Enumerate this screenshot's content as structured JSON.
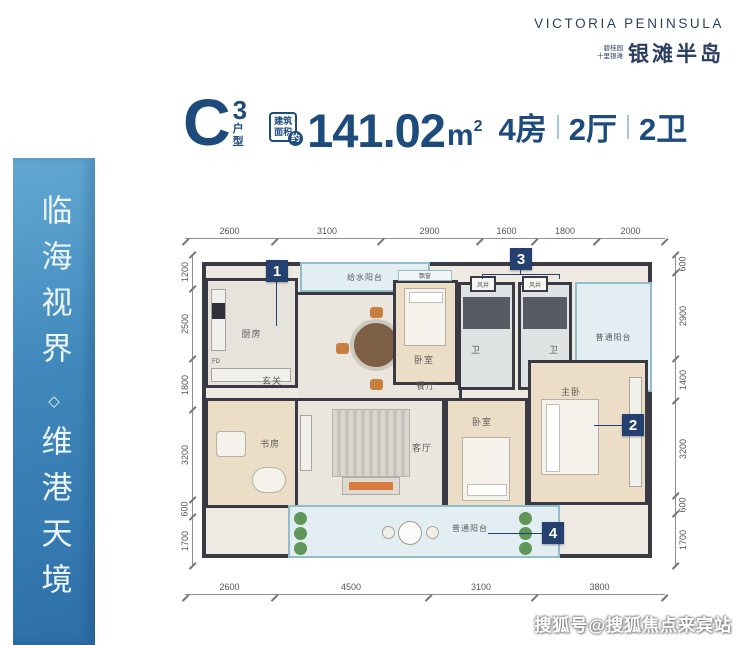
{
  "brand": {
    "en_name": "VICTORIA PENINSULA",
    "cn_tagline_1": "碧桂园",
    "cn_tagline_2": "十里银滩",
    "cn_name": "银滩半岛"
  },
  "title": {
    "plan_letter": "C",
    "plan_sup": "3",
    "plan_label": "户型",
    "area_label_1": "建筑",
    "area_label_2": "面积",
    "area_approx": "约",
    "area_value": "141.02",
    "area_unit": "m",
    "area_unit_sup": "2",
    "layout_rooms": "4房",
    "layout_halls": "2厅",
    "layout_baths": "2卫"
  },
  "side_banner": {
    "line1": "临海视界",
    "separator": "◇",
    "line2": "维港天境"
  },
  "floorplan": {
    "dims_top": [
      "2600",
      "3100",
      "2900",
      "1600",
      "1800",
      "2000"
    ],
    "dims_bottom": [
      "2600",
      "4500",
      "3100",
      "3800"
    ],
    "dims_left": [
      "1200",
      "2500",
      "1800",
      "3200",
      "600",
      "1700"
    ],
    "dims_right": [
      "600",
      "2900",
      "1400",
      "3200",
      "600",
      "1700"
    ],
    "rooms": {
      "water_balcony": "给水阳台",
      "kitchen": "厨房",
      "kitchen_fd": "FD",
      "dining": "餐厅",
      "foyer": "玄关",
      "study": "书房",
      "living": "客厅",
      "bedroom_top": "卧室",
      "bedroom_bottom": "卧室",
      "master_bedroom": "主卧",
      "bath1": "卫",
      "bath2": "卫",
      "balcony_top": "普通阳台",
      "balcony_bottom": "普通阳台",
      "bay_window": "飘窗",
      "vent_shaft_1": "风井",
      "vent_shaft_2": "风井"
    },
    "badges": {
      "b1": "1",
      "b2": "2",
      "b3": "3",
      "b4": "4"
    }
  },
  "watermark": "搜狐号@搜狐焦点来宾站",
  "colors": {
    "navy_text": "#1d4b7c",
    "badge_navy": "#24406f",
    "banner_top": "#63a9d3",
    "banner_bottom": "#2d6fa8",
    "wall": "#3a3a45",
    "balcony_border": "#93bccb"
  }
}
